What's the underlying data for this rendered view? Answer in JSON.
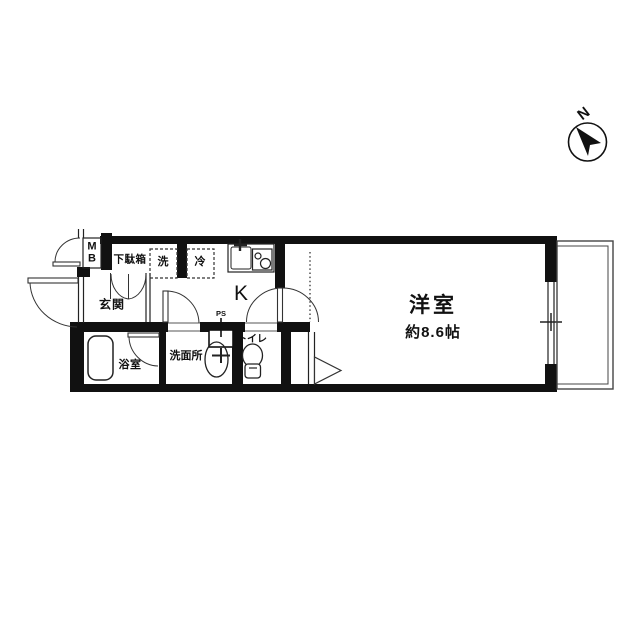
{
  "title": "apartment-floor-plan",
  "compass": {
    "north_label": "N"
  },
  "rooms": {
    "meter_box": {
      "line1": "M",
      "line2": "B"
    },
    "shoe_cabinet": "下駄箱",
    "washer": "洗",
    "fridge": "冷",
    "kitchen": "K",
    "pipe_space": "PS",
    "entrance": "玄関",
    "bathroom": "浴室",
    "washroom": "洗面所",
    "toilet": "トイレ",
    "western_room": "洋室",
    "western_room_size": "約8.6帖"
  },
  "icons": [
    "north-compass-icon",
    "bathtub-icon",
    "washbasin-icon",
    "toilet-icon",
    "kitchen-sink-icon",
    "stove-icon",
    "window-icon",
    "door-arc"
  ],
  "colors": {
    "background": "#ffffff",
    "wall": "#111111",
    "line": "#222222",
    "text": "#111111"
  }
}
